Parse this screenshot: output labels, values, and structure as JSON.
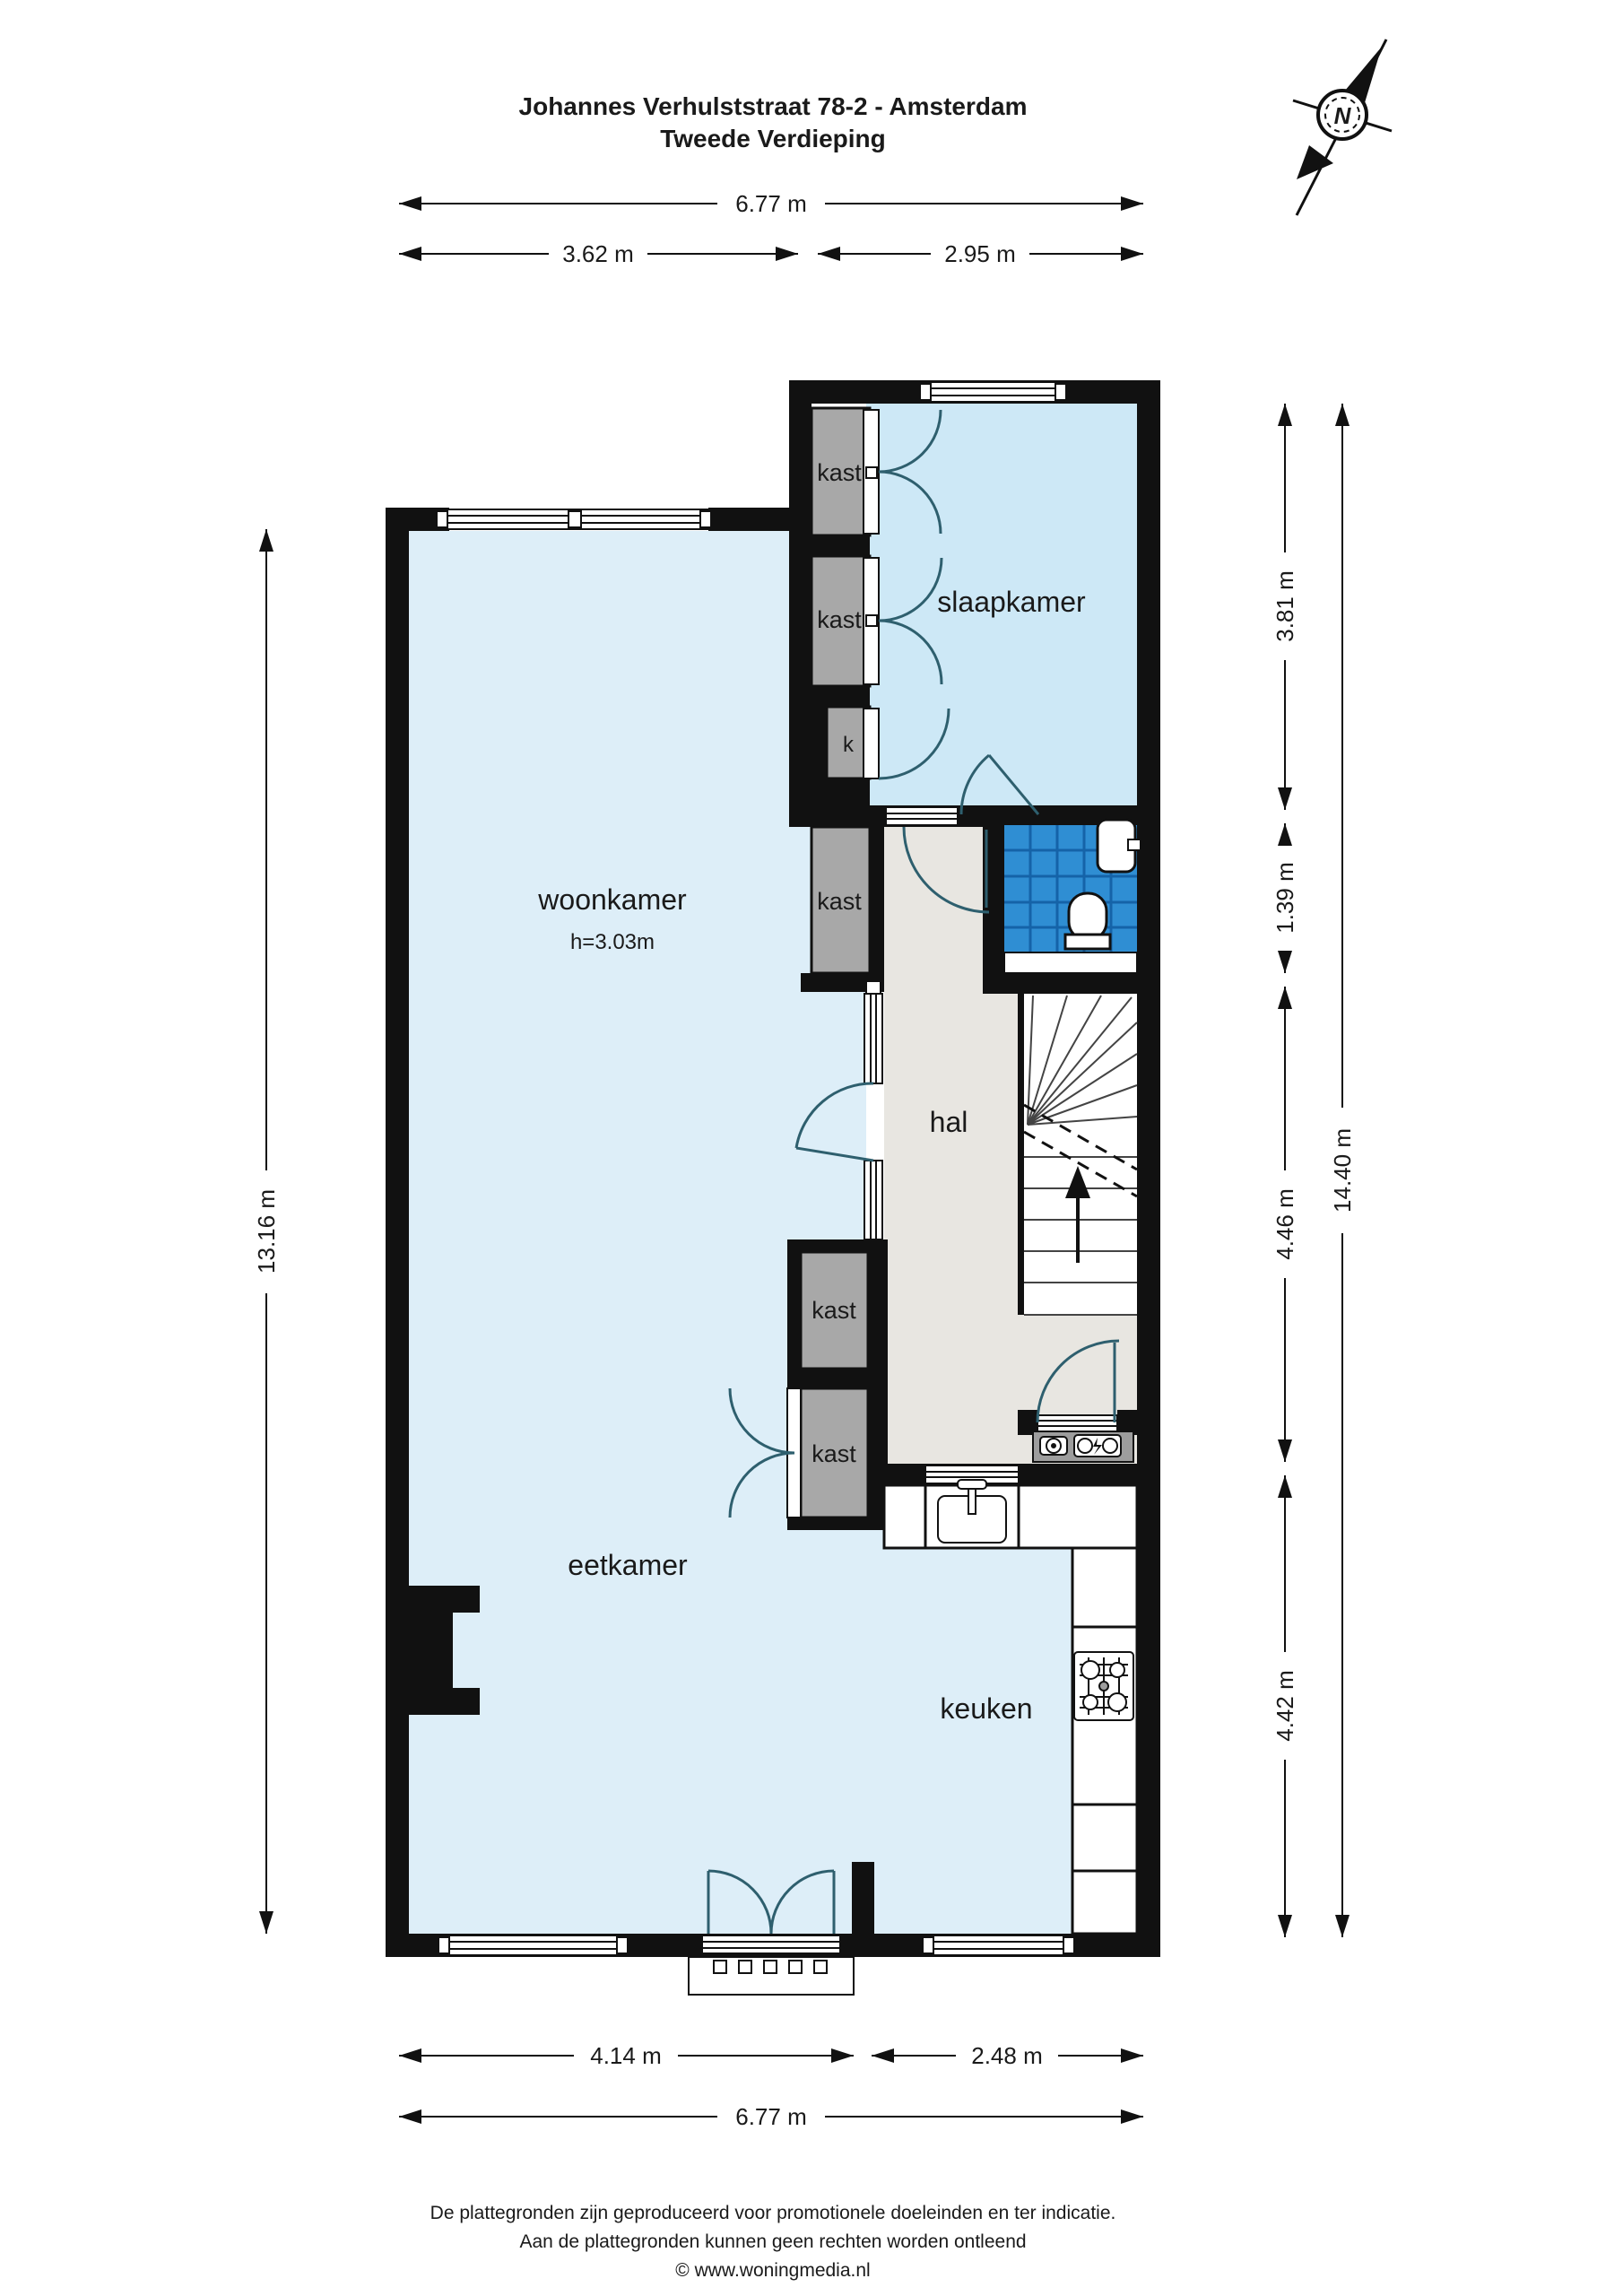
{
  "title": {
    "line1": "Johannes Verhulststraat 78-2 - Amsterdam",
    "line2": "Tweede Verdieping"
  },
  "compass": {
    "label": "N"
  },
  "room_labels": {
    "woonkamer": "woonkamer",
    "woonkamer_height": "h=3.03m",
    "slaapkamer": "slaapkamer",
    "hal": "hal",
    "eetkamer": "eetkamer",
    "keuken": "keuken",
    "kast": "kast",
    "kast_small": "k"
  },
  "dimensions": {
    "top": {
      "total": "6.77 m",
      "left": "3.62 m",
      "right": "2.95 m"
    },
    "bottom": {
      "left": "4.14 m",
      "right": "2.48 m",
      "total": "6.77 m"
    },
    "left": {
      "total": "13.16 m"
    },
    "right": {
      "slaapkamer": "3.81 m",
      "badkamer": "1.39 m",
      "hal": "4.46 m",
      "keuken": "4.42 m",
      "total": "14.40 m"
    }
  },
  "footer": {
    "line1": "De plattegronden zijn geproduceerd voor promotionele doeleinden en ter indicatie.",
    "line2": "Aan de plattegronden kunnen geen rechten worden ontleend",
    "line3": "© www.woningmedia.nl"
  },
  "colors": {
    "wall": "#111111",
    "room_fill": "#ddeef8",
    "slaapkamer_fill": "#cde8f6",
    "hal_fill": "#e8e6e1",
    "kast_fill": "#a8a8a8",
    "bathroom_tile": "#2f8ed3",
    "bathroom_grout": "#1563a8",
    "meter_shelf": "#9d9d9d",
    "door_arc": "#2e5f6e",
    "text": "#1a1a1a"
  }
}
